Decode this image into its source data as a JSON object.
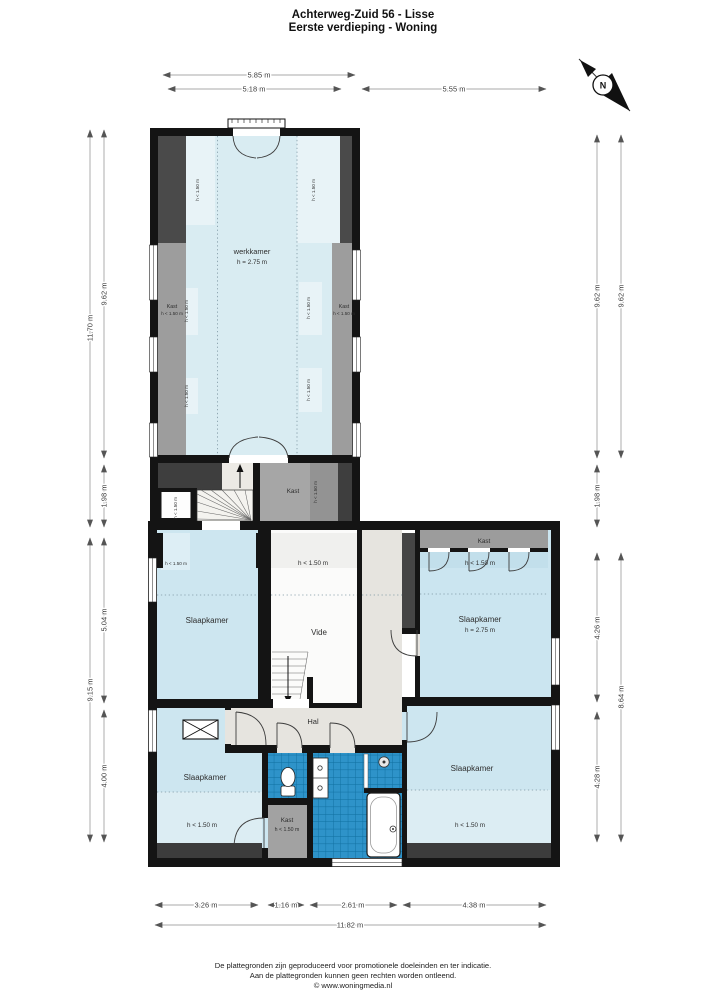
{
  "header": {
    "title1": "Achterweg-Zuid 56 - Lisse",
    "title2": "Eerste verdieping - Woning"
  },
  "compass": {
    "n": "N"
  },
  "labels": {
    "werkkamer": "werkkamer",
    "h275": "h = 2.75 m",
    "slaapkamer": "Slaapkamer",
    "vide": "Vide",
    "hal": "Hal",
    "kast": "Kast",
    "h150": "h < 1.50 m"
  },
  "dims": {
    "top_outer": "5.85 m",
    "top_left": "5.18 m",
    "top_right": "5.55 m",
    "l_out_up": "11.70 m",
    "l_in_up": "9.62 m",
    "l_mid": "1.98 m",
    "l_out_low": "9.15 m",
    "l_in_low_a": "5.04 m",
    "l_in_low_b": "4.00 m",
    "r_in_up": "9.62 m",
    "r_out_up": "9.62 m",
    "r_mid": "1.98 m",
    "r_in_low_a": "4.26 m",
    "r_in_low_b": "4.28 m",
    "r_out_low": "8.64 m",
    "b_a": "3.26 m",
    "b_b": "1.16 m",
    "b_c": "2.61 m",
    "b_d": "4.38 m",
    "b_total": "11.82 m"
  },
  "footer": {
    "l1": "De plattegronden zijn geproduceerd voor promotionele doeleinden en ter indicatie.",
    "l2": "Aan de plattegronden kunnen geen rechten worden ontleend.",
    "l3": "© www.woningmedia.nl"
  },
  "colors": {
    "wall": "#141414",
    "room_blue": "#cde6f0",
    "room_blue_light": "#ddeef5",
    "werkkamer_blue": "#d9ecf2",
    "werkkamer_blue_light": "#e8f3f7",
    "tile_blue": "#2e93c9",
    "tile_grid": "#0f6fa0",
    "hal_beige": "#e6e4df",
    "kast_gray": "#a0a0a0",
    "dark_zone": "#3e3e3e",
    "vide_white": "#fbfbfa"
  }
}
